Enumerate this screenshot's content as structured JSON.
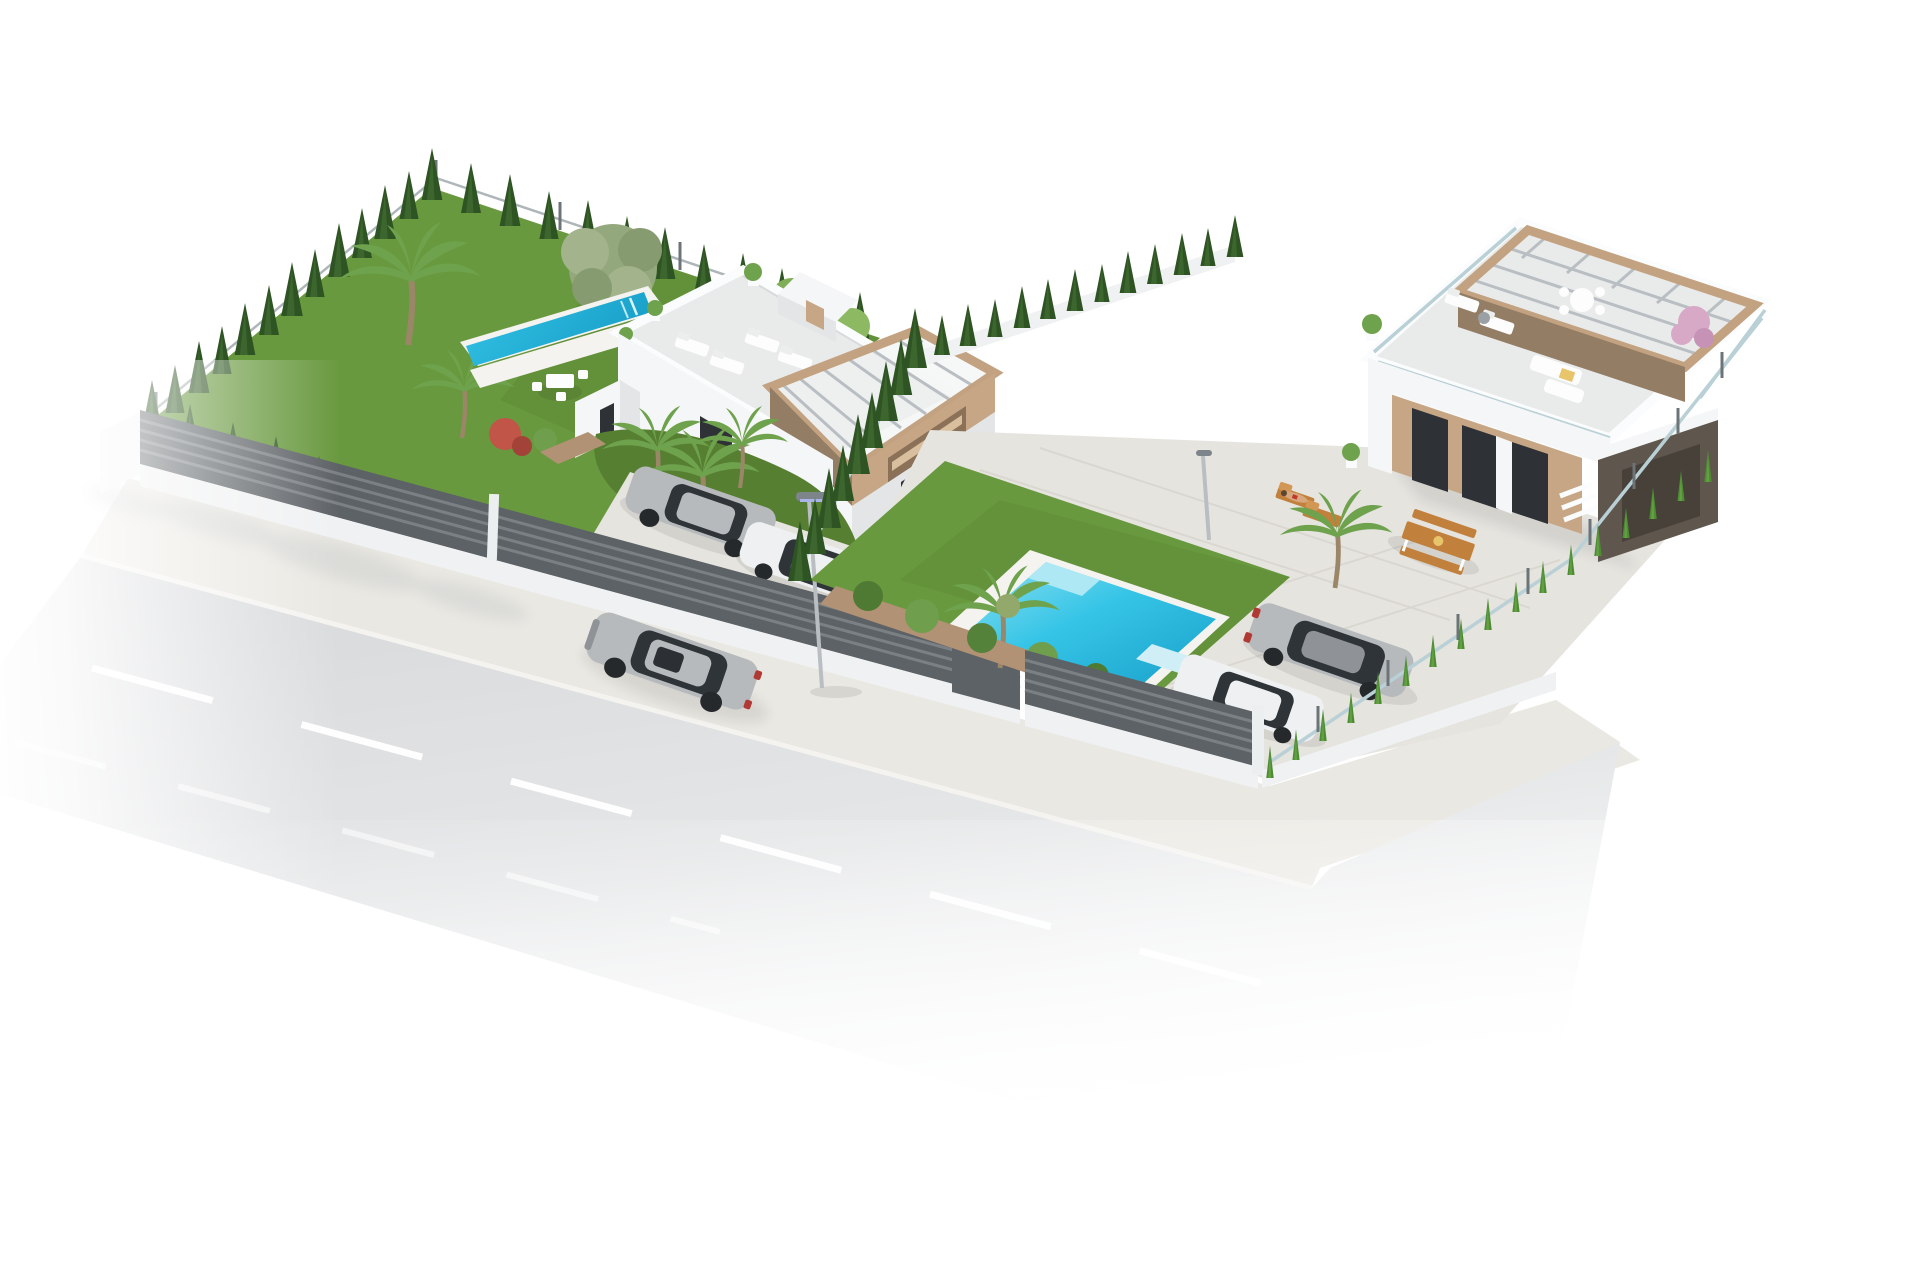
{
  "scene": {
    "kind": "3D architectural exterior rendering",
    "description": "Aerial three-quarter view of two modern white flat-roof villas on a corner plot, isolated on a pure white background. A gray asphalt road with white lane markings and a driving silver sedan runs diagonally along the lower left; a paved sidewalk, white base walls and dark horizontal-slat fences separate the street from the gardens.",
    "villa_left": {
      "name": "two-storey villa with pergola tower",
      "features": [
        "white roof terrace with parapet, four white sun loungers and potted plants",
        "beige pergola tower with metal slat roof and window openings",
        "narrow lap pool set in the lawn beside the house",
        "large lawn with olive tree and tall palms",
        "conifer hedge and wire mesh fence on the boundaries",
        "white garden dining set",
        "planting bed with red flowering shrub and three slender palms",
        "driveway with a silver car and a white car parked behind the slat fence"
      ]
    },
    "villa_right": {
      "name": "single-storey villa with rooftop pergola terrace",
      "features": [
        "rooftop terrace with glass balustrade, wooden pergola, round dining table, white loungers, fire pit and outdoor sofa set",
        "pink flowering tree at the roof corner",
        "ground terrace with wooden picnic table, two wooden sun loungers and a sunbather",
        "rectangular turquoise pool in the lawn with white coping and corner steps",
        "dark taupe garage wing with wood-clad sliding doors",
        "columnar cypress hedge with glass fence on the right boundary",
        "tall conifer hedge separating the two plots",
        "driveway with a parked silver coupe and a white car"
      ]
    },
    "street": {
      "elements": [
        "asphalt road fading to white at the image edges",
        "dashed white center line",
        "silver sedan driving toward lower left",
        "paved sidewalk with soft tree shadows",
        "street lamp on the sidewalk"
      ]
    }
  },
  "palette": {
    "bg": "#ffffff",
    "roadTop": "#d6d8da",
    "roadMid": "#e4e6e7",
    "laneLine": "#ffffff",
    "sidewalk": "#eae8e2",
    "curb": "#f4f3f0",
    "wall": "#f5f6f7",
    "wallShade": "#e3e5e7",
    "wallDark": "#d5d7d9",
    "parapet": "#fbfcfd",
    "terracePale": "#e9ebeb",
    "windowDark": "#2e3236",
    "woodDoor": "#6b5b49",
    "pergolaTan": "#c2a280",
    "pergolaDark": "#937d64",
    "towerTanWall": "#c6a684",
    "lawn": "#69993f",
    "lawnShade": "#567f31",
    "hedge": "#2f5424",
    "hedgeLight": "#477536",
    "hedgeBright": "#4e8c33",
    "palmGreen": "#6fa24d",
    "olive": "#93a87c",
    "poolWater": "#35c4e6",
    "poolDeep": "#189fc9",
    "poolLight": "#8fe2f2",
    "coping": "#f4f3ef",
    "pavement": "#e6e4df",
    "pavementLine": "#d8d5ce",
    "fence": "#5d6266",
    "fenceSlat": "#7b8084",
    "fenceBase": "#f0f1f2",
    "meshFence": "#aeb6ba",
    "glassFence": "#b9d0d6",
    "postGray": "#6c7478",
    "carSilver": "#b7babd",
    "carSilverDark": "#8f9397",
    "carWhite": "#eef0f1",
    "carGlass": "#2f3438",
    "woodFurn": "#c1803c",
    "skin": "#d9a77e",
    "pinkTree": "#d7a9c7",
    "planterTan": "#b29274",
    "metalPole": "#b9bec3",
    "softShadow": "#c9cccd"
  }
}
